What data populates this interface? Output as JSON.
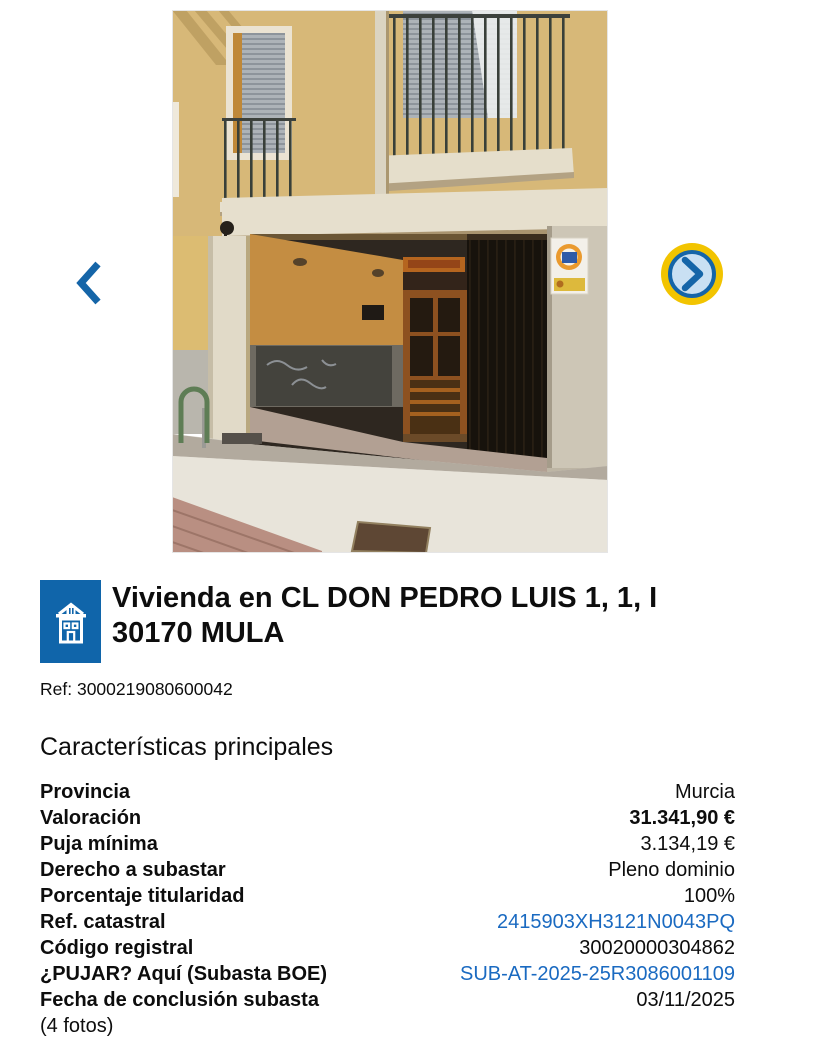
{
  "gallery": {
    "prev_icon": "chevron-left",
    "next_icon": "chevron-right",
    "photo": "property-facade-photo"
  },
  "listing": {
    "icon": "building-icon",
    "title_line1": "Vivienda en CL DON PEDRO LUIS 1, 1, I",
    "title_line2": "30170 MULA",
    "reference": "Ref: 3000219080600042"
  },
  "characteristics": {
    "heading": "Características principales",
    "rows": [
      {
        "label": "Provincia",
        "value": "Murcia",
        "value_style": "normal"
      },
      {
        "label": "Valoración",
        "value": "31.341,90 €",
        "value_style": "bold"
      },
      {
        "label": "Puja mínima",
        "value": "3.134,19 €",
        "value_style": "normal"
      },
      {
        "label": "Derecho a subastar",
        "value": "Pleno dominio",
        "value_style": "normal"
      },
      {
        "label": "Porcentaje titularidad",
        "value": "100%",
        "value_style": "normal"
      },
      {
        "label": "Ref. catastral",
        "value": "2415903XH3121N0043PQ",
        "value_style": "link"
      },
      {
        "label": "Código registral",
        "value": "30020000304862",
        "value_style": "normal"
      },
      {
        "label": "¿PUJAR? Aquí (Subasta BOE)",
        "value": "SUB-AT-2025-25R3086001109",
        "value_style": "link"
      },
      {
        "label": "Fecha de conclusión subasta",
        "value": "03/11/2025",
        "value_style": "normal"
      }
    ],
    "footnote": "(4 fotos)"
  },
  "colors": {
    "accent_blue": "#1565a8",
    "icon_blue": "#1065aa",
    "link_blue": "#1a6ac1",
    "focus_yellow": "#f2c400",
    "focus_fill": "#c9e0f3"
  }
}
